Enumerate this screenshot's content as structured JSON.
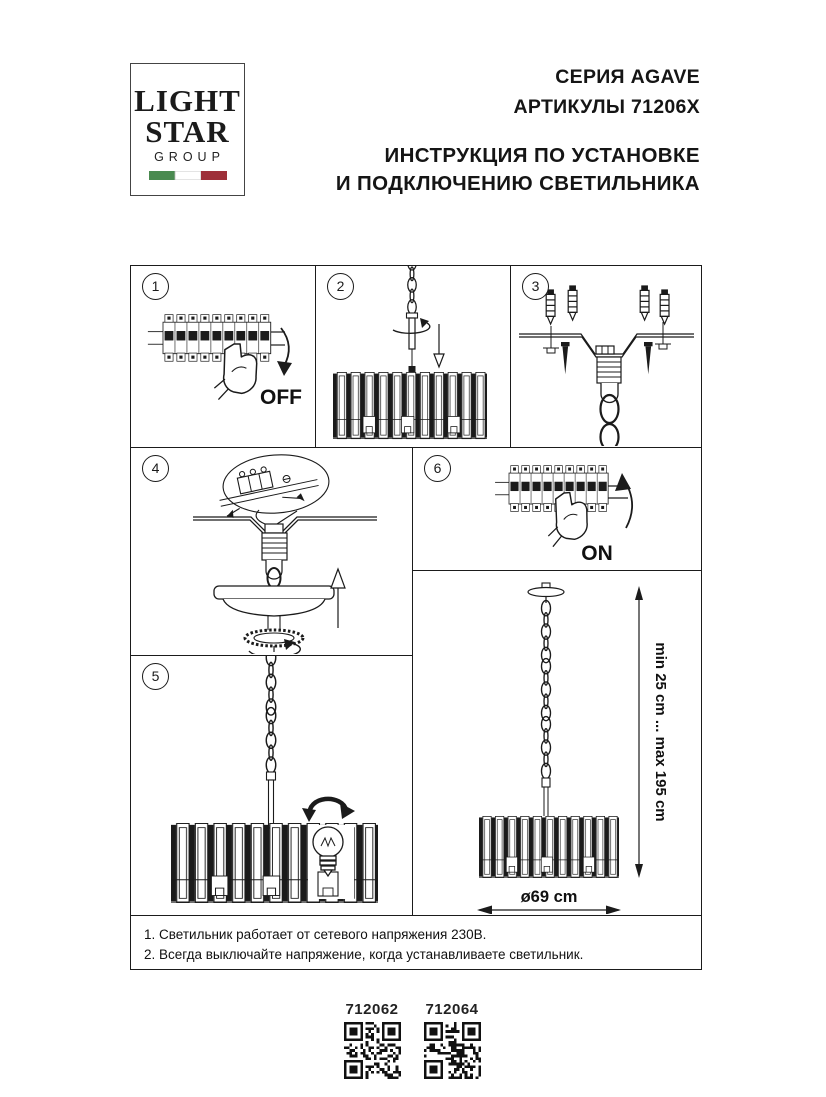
{
  "logo": {
    "line1": "LIGHT",
    "line2": "STAR",
    "line3": "GROUP"
  },
  "header": {
    "series": "СЕРИЯ AGAVE",
    "articles": "АРТИКУЛЫ 71206X",
    "title1": "ИНСТРУКЦИЯ ПО УСТАНОВКЕ",
    "title2": "И ПОДКЛЮЧЕНИЮ СВЕТИЛЬНИКА"
  },
  "steps": [
    {
      "number": "1",
      "illustration": "circuit-breaker-switch-off",
      "label": "OFF"
    },
    {
      "number": "2",
      "illustration": "thread-suspension-rod-into-shade"
    },
    {
      "number": "3",
      "illustration": "ceiling-bracket-with-anchors-and-screws"
    },
    {
      "number": "4",
      "illustration": "connect-wires-terminal-block-and-raise-canopy"
    },
    {
      "number": "5",
      "illustration": "hang-fixture-and-screw-in-bulb"
    },
    {
      "number": "6",
      "illustration": "circuit-breaker-switch-on",
      "label": "ON"
    }
  ],
  "dimensions": {
    "suspension": "min 25 cm ... max 195 cm",
    "diameter": "ø69 cm"
  },
  "notes": [
    "1. Светильник работает от сетевого напряжения 230В.",
    "2. Всегда выключайте напряжение, когда устанавливаете светильник."
  ],
  "articles": [
    {
      "code": "712062"
    },
    {
      "code": "712064"
    }
  ],
  "colors": {
    "ink": "#1b1b1b",
    "flag_green": "#4a8a50",
    "flag_red": "#9e2f39"
  }
}
